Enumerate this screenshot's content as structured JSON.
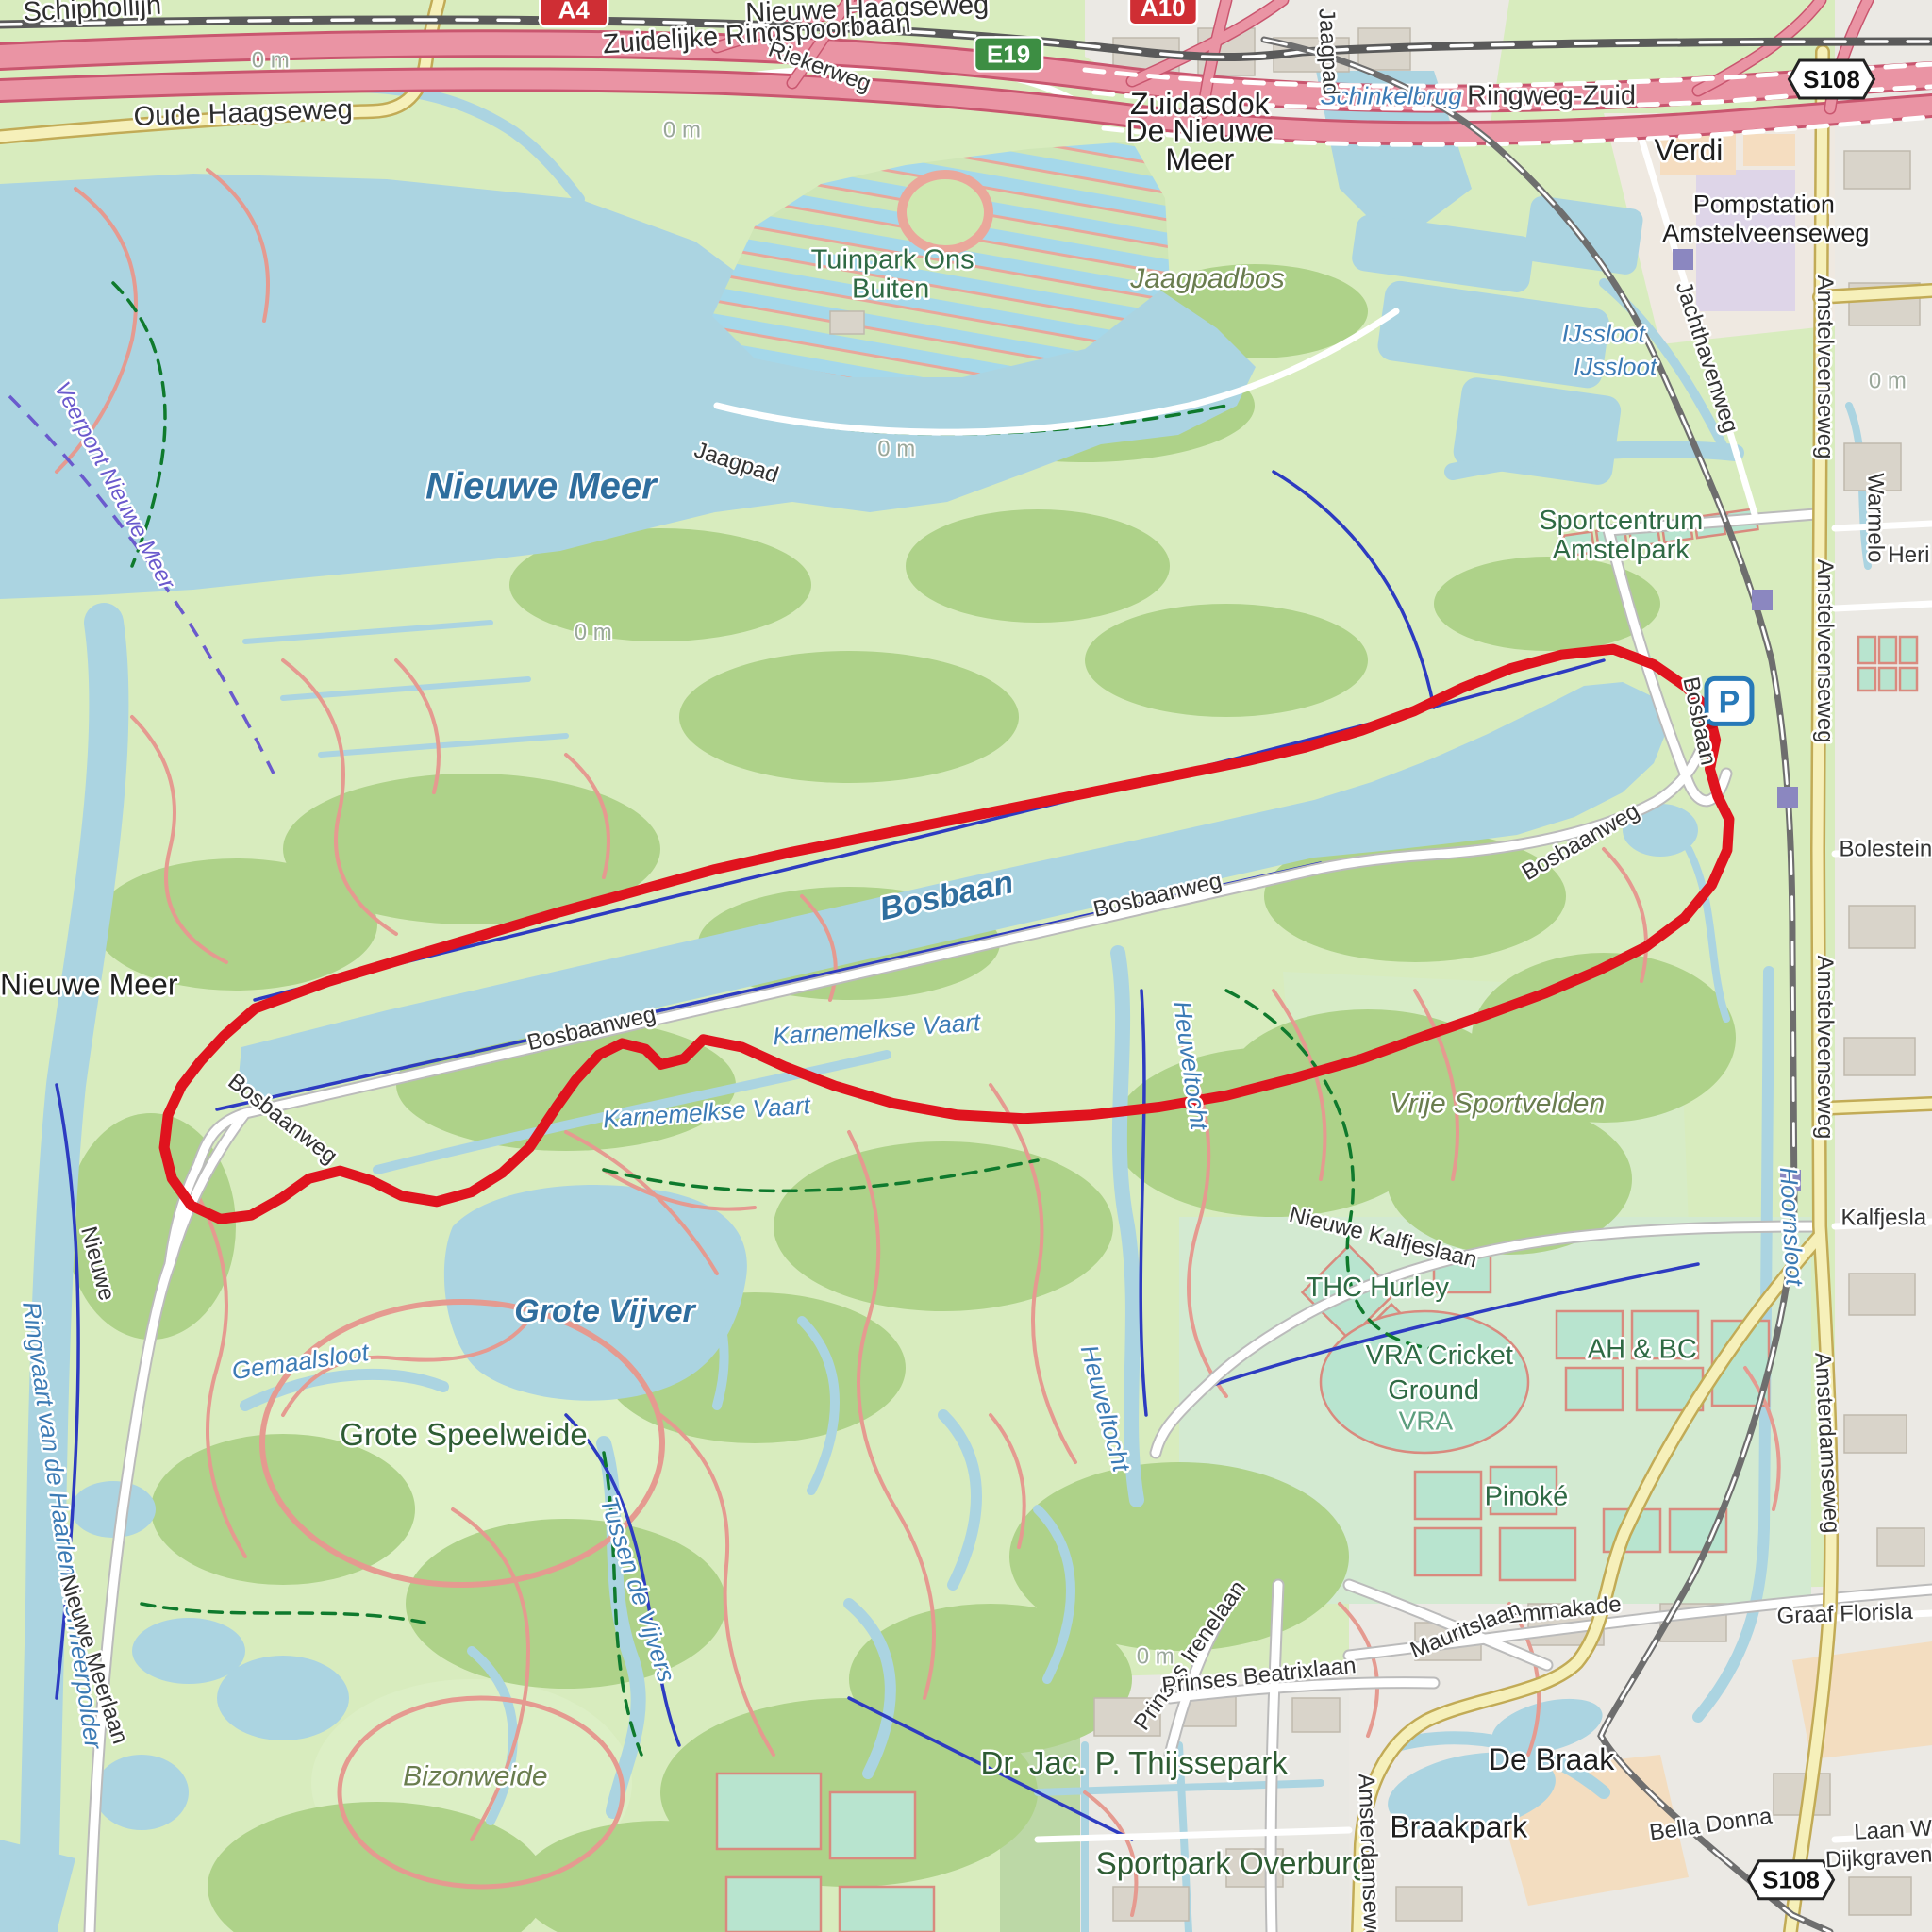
{
  "map": {
    "colors": {
      "route": "#e0131e",
      "route_dot": "#c01018",
      "water": "#abd4e1",
      "motorway": "#ea94a4",
      "road_yellow": "#f6f0ba",
      "parking_blue": "#2779b8",
      "shield_red": "#cf2e34",
      "shield_green": "#3d8e43"
    },
    "parking_icon": {
      "label": "P",
      "x": 89.5,
      "y": 36.3
    },
    "shields": [
      {
        "text": "A4",
        "type": "a",
        "x": 29.7,
        "y": 0.5
      },
      {
        "text": "A10",
        "type": "a",
        "x": 60.2,
        "y": 0.4
      },
      {
        "text": "E19",
        "type": "e",
        "x": 52.2,
        "y": 2.8
      },
      {
        "text": "S108",
        "type": "s",
        "x": 94.8,
        "y": 4.1
      },
      {
        "text": "S108",
        "type": "s",
        "x": 92.7,
        "y": 97.3
      }
    ],
    "labels": [
      {
        "t": "Schiphollijn",
        "x": 4.8,
        "y": 0.9,
        "r": -3,
        "c": "street-lg"
      },
      {
        "t": "Oude Haagseweg",
        "x": 12.6,
        "y": 6.3,
        "r": -2,
        "c": "street-lg"
      },
      {
        "t": "Nieuwe Haagseweg",
        "x": 44.9,
        "y": 0.9,
        "r": -2,
        "c": "street-lg"
      },
      {
        "t": "Zuidelijke Ringspoorbaan",
        "x": 39.2,
        "y": 2.2,
        "r": -4,
        "c": "street-lg"
      },
      {
        "t": "Riekerweg",
        "x": 42.3,
        "y": 3.8,
        "r": 20,
        "c": "street"
      },
      {
        "t": "Zuidasdok",
        "x": 62.1,
        "y": 5.9,
        "r": 0,
        "c": "place-m"
      },
      {
        "t": "De Nieuwe",
        "x": 62.1,
        "y": 7.3,
        "r": 0,
        "c": "place-m"
      },
      {
        "t": "Meer",
        "x": 62.1,
        "y": 8.8,
        "r": 0,
        "c": "place-m"
      },
      {
        "t": "Schinkelbrug",
        "x": 72.0,
        "y": 5.4,
        "r": 0,
        "c": "water-s"
      },
      {
        "t": "Ringweg-Zuid",
        "x": 80.3,
        "y": 5.4,
        "r": 0,
        "c": "street-lg"
      },
      {
        "t": "Jaagpad",
        "x": 68.4,
        "y": 2.7,
        "r": 87,
        "c": "street"
      },
      {
        "t": "Verdi",
        "x": 87.4,
        "y": 8.3,
        "r": 0,
        "c": "place-m"
      },
      {
        "t": "Pompstation",
        "x": 91.3,
        "y": 11.0,
        "r": 0,
        "c": "place-s"
      },
      {
        "t": "Amstelveenseweg",
        "x": 91.4,
        "y": 12.5,
        "r": 0,
        "c": "place-s"
      },
      {
        "t": "IJssloot",
        "x": 83.0,
        "y": 17.7,
        "r": 0,
        "c": "water-s"
      },
      {
        "t": "IJssloot",
        "x": 83.6,
        "y": 19.4,
        "r": 0,
        "c": "water-s"
      },
      {
        "t": "Jachthavenweg",
        "x": 88.0,
        "y": 18.6,
        "r": 72,
        "c": "street"
      },
      {
        "t": "Amstelveenseweg",
        "x": 94.1,
        "y": 19.0,
        "r": 90,
        "c": "street"
      },
      {
        "t": "Amstelveenseweg",
        "x": 94.1,
        "y": 33.7,
        "r": 90,
        "c": "street"
      },
      {
        "t": "Amstelveenseweg",
        "x": 94.1,
        "y": 54.2,
        "r": 90,
        "c": "street"
      },
      {
        "t": "Warmelo",
        "x": 96.7,
        "y": 26.8,
        "r": 90,
        "c": "street"
      },
      {
        "t": "Heri",
        "x": 98.8,
        "y": 29.1,
        "r": 0,
        "c": "street"
      },
      {
        "t": "Tuinpark Ons",
        "x": 46.2,
        "y": 13.9,
        "r": 0,
        "c": "park"
      },
      {
        "t": "Buiten",
        "x": 46.1,
        "y": 15.4,
        "r": 0,
        "c": "park"
      },
      {
        "t": "Jaagpadbos",
        "x": 62.5,
        "y": 14.9,
        "r": 0,
        "c": "area"
      },
      {
        "t": "Jaagpad",
        "x": 38.0,
        "y": 24.3,
        "r": 18,
        "c": "street"
      },
      {
        "t": "Veerpont Nieuwe Meer",
        "x": 5.6,
        "y": 25.3,
        "r": 62,
        "c": "ferry"
      },
      {
        "t": "Nieuwe Meer",
        "x": 28.0,
        "y": 25.8,
        "r": 0,
        "c": "water-xl"
      },
      {
        "t": "Nieuwe Meer",
        "x": 4.6,
        "y": 51.5,
        "r": 0,
        "c": "place-m"
      },
      {
        "t": "Sportcentrum",
        "x": 83.9,
        "y": 27.4,
        "r": 0,
        "c": "park"
      },
      {
        "t": "Amstelpark",
        "x": 83.9,
        "y": 28.9,
        "r": 0,
        "c": "park"
      },
      {
        "t": "Bosbaan",
        "x": 87.6,
        "y": 37.4,
        "r": 78,
        "c": "street"
      },
      {
        "t": "Bosbaan",
        "x": 49.1,
        "y": 46.9,
        "r": -12,
        "c": "water-l"
      },
      {
        "t": "Bosbaanweg",
        "x": 60.0,
        "y": 46.7,
        "r": -13,
        "c": "street"
      },
      {
        "t": "Bosbaanweg",
        "x": 30.7,
        "y": 53.6,
        "r": -13,
        "c": "street"
      },
      {
        "t": "Bosbaanweg",
        "x": 14.4,
        "y": 58.2,
        "r": 38,
        "c": "street"
      },
      {
        "t": "Bosbaanweg",
        "x": 82.0,
        "y": 43.9,
        "r": -30,
        "c": "street"
      },
      {
        "t": "Karnemelkse Vaart",
        "x": 36.6,
        "y": 58.0,
        "r": -4,
        "c": "water-s"
      },
      {
        "t": "Karnemelkse Vaart",
        "x": 45.4,
        "y": 53.7,
        "r": -4,
        "c": "water-s"
      },
      {
        "t": "Heuveltocht",
        "x": 61.2,
        "y": 55.2,
        "r": 82,
        "c": "water-s"
      },
      {
        "t": "Heuveltocht",
        "x": 56.8,
        "y": 73.0,
        "r": 75,
        "c": "water-s"
      },
      {
        "t": "Vrije Sportvelden",
        "x": 77.5,
        "y": 57.6,
        "r": 0,
        "c": "area"
      },
      {
        "t": "Hoornsloot",
        "x": 92.3,
        "y": 63.5,
        "r": 87,
        "c": "water-s"
      },
      {
        "t": "Bolestein",
        "x": 97.6,
        "y": 44.3,
        "r": 0,
        "c": "street"
      },
      {
        "t": "Kalfjesla",
        "x": 97.5,
        "y": 63.4,
        "r": 0,
        "c": "street"
      },
      {
        "t": "Nieuwe Kalfjeslaan",
        "x": 71.5,
        "y": 64.4,
        "r": 14,
        "c": "street"
      },
      {
        "t": "THC Hurley",
        "x": 71.3,
        "y": 67.1,
        "r": 0,
        "c": "park"
      },
      {
        "t": "VRA Cricket",
        "x": 74.5,
        "y": 70.6,
        "r": 0,
        "c": "park"
      },
      {
        "t": "Ground",
        "x": 74.2,
        "y": 72.4,
        "r": 0,
        "c": "park"
      },
      {
        "t": "VRA",
        "x": 73.8,
        "y": 74.0,
        "r": 0,
        "c": "area-teal"
      },
      {
        "t": "AH & BC",
        "x": 85.0,
        "y": 70.3,
        "r": 0,
        "c": "park"
      },
      {
        "t": "Pinoké",
        "x": 79.0,
        "y": 77.9,
        "r": 0,
        "c": "park"
      },
      {
        "t": "Grote Vijver",
        "x": 31.3,
        "y": 68.4,
        "r": 0,
        "c": "water-l"
      },
      {
        "t": "Gemaalsloot",
        "x": 15.6,
        "y": 70.9,
        "r": -8,
        "c": "water-s"
      },
      {
        "t": "Grote Speelweide",
        "x": 24.0,
        "y": 74.8,
        "r": 0,
        "c": "park-l"
      },
      {
        "t": "Tussen de Vijvers",
        "x": 32.6,
        "y": 82.4,
        "r": 72,
        "c": "water-s"
      },
      {
        "t": "Bizonweide",
        "x": 24.6,
        "y": 92.4,
        "r": 0,
        "c": "area"
      },
      {
        "t": "Ringvaart van de Haarlemmermeerpolder",
        "x": 2.8,
        "y": 79.0,
        "r": 82,
        "c": "water-s"
      },
      {
        "t": "Nieuwe",
        "x": 4.7,
        "y": 65.5,
        "r": 75,
        "c": "street"
      },
      {
        "t": "Nieuwe Meerlaan",
        "x": 4.5,
        "y": 86.0,
        "r": 72,
        "c": "street"
      },
      {
        "t": "Dr. Jac. P. Thijssepark",
        "x": 58.7,
        "y": 91.8,
        "r": 0,
        "c": "park-l"
      },
      {
        "t": "Prinses Irenelaan",
        "x": 61.9,
        "y": 85.9,
        "r": -55,
        "c": "street"
      },
      {
        "t": "Prinses Beatrixlaan",
        "x": 65.2,
        "y": 87.1,
        "r": -6,
        "c": "street"
      },
      {
        "t": "Emmakade",
        "x": 81.0,
        "y": 83.7,
        "r": -6,
        "c": "street"
      },
      {
        "t": "Mauritslaan",
        "x": 76.0,
        "y": 84.7,
        "r": -22,
        "c": "street"
      },
      {
        "t": "De Braak",
        "x": 80.3,
        "y": 91.6,
        "r": 0,
        "c": "place-m"
      },
      {
        "t": "Braakpark",
        "x": 75.5,
        "y": 95.1,
        "r": 0,
        "c": "place-m"
      },
      {
        "t": "Sportpark Overburg",
        "x": 63.8,
        "y": 97.0,
        "r": 0,
        "c": "park-l"
      },
      {
        "t": "Amsterdamseweg",
        "x": 94.2,
        "y": 74.7,
        "r": 87,
        "c": "street"
      },
      {
        "t": "Amsterdamseweg",
        "x": 70.5,
        "y": 96.5,
        "r": 88,
        "c": "street"
      },
      {
        "t": "Bella Donna",
        "x": 88.6,
        "y": 94.8,
        "r": -8,
        "c": "street"
      },
      {
        "t": "Laan W",
        "x": 98.0,
        "y": 95.1,
        "r": -3,
        "c": "street"
      },
      {
        "t": "Dijkgravenl",
        "x": 97.4,
        "y": 96.5,
        "r": -3,
        "c": "street"
      },
      {
        "t": "Graaf Florisla",
        "x": 95.5,
        "y": 83.9,
        "r": -2,
        "c": "street"
      },
      {
        "t": "0 m",
        "x": 14.0,
        "y": 3.5,
        "r": 0,
        "c": "contour"
      },
      {
        "t": "0 m",
        "x": 35.3,
        "y": 7.1,
        "r": 0,
        "c": "contour"
      },
      {
        "t": "0 m",
        "x": 46.4,
        "y": 23.6,
        "r": 0,
        "c": "contour"
      },
      {
        "t": "0 m",
        "x": 97.7,
        "y": 20.1,
        "r": 0,
        "c": "contour"
      },
      {
        "t": "0 m",
        "x": 59.8,
        "y": 86.1,
        "r": 0,
        "c": "contour"
      },
      {
        "t": "0 m",
        "x": 30.7,
        "y": 33.1,
        "r": 0,
        "c": "contour"
      }
    ],
    "route": {
      "width": 11,
      "end_dot": [
        88.5,
        37.1
      ],
      "points": [
        [
          13.2,
          52.2
        ],
        [
          17,
          50.8
        ],
        [
          21,
          49.6
        ],
        [
          25,
          48.4
        ],
        [
          29,
          47.2
        ],
        [
          33,
          46.1
        ],
        [
          37,
          45
        ],
        [
          41,
          44.1
        ],
        [
          45,
          43.3
        ],
        [
          49,
          42.5
        ],
        [
          53,
          41.7
        ],
        [
          57,
          40.9
        ],
        [
          61,
          40.1
        ],
        [
          64.5,
          39.4
        ],
        [
          67.5,
          38.7
        ],
        [
          70.5,
          37.8
        ],
        [
          73.2,
          36.8
        ],
        [
          75.7,
          35.6
        ],
        [
          78.2,
          34.6
        ],
        [
          80.8,
          33.9
        ],
        [
          83.5,
          33.6
        ],
        [
          85.6,
          34.4
        ],
        [
          87.2,
          35.5
        ],
        [
          88.3,
          36.6
        ],
        [
          88.5,
          37.1
        ],
        [
          88.8,
          38.3
        ],
        [
          88.5,
          39.8
        ],
        [
          88.9,
          41.2
        ],
        [
          89.5,
          42.4
        ],
        [
          89.4,
          44
        ],
        [
          88.6,
          45.8
        ],
        [
          87.2,
          47.5
        ],
        [
          85.2,
          49
        ],
        [
          82.8,
          50.2
        ],
        [
          80,
          51.4
        ],
        [
          77,
          52.5
        ],
        [
          73.8,
          53.6
        ],
        [
          70.5,
          54.8
        ],
        [
          67,
          55.8
        ],
        [
          63.5,
          56.7
        ],
        [
          60,
          57.3
        ],
        [
          56.5,
          57.7
        ],
        [
          53,
          57.9
        ],
        [
          49.5,
          57.7
        ],
        [
          46.2,
          57.1
        ],
        [
          43.2,
          56.2
        ],
        [
          40.6,
          55.2
        ],
        [
          38.4,
          54.2
        ],
        [
          36.4,
          53.8
        ],
        [
          35.4,
          54.8
        ],
        [
          34.2,
          55.1
        ],
        [
          33.4,
          54.3
        ],
        [
          32.2,
          54
        ],
        [
          31,
          54.6
        ],
        [
          29.8,
          55.9
        ],
        [
          28.8,
          57.3
        ],
        [
          27.4,
          59.4
        ],
        [
          26,
          60.7
        ],
        [
          24.4,
          61.7
        ],
        [
          22.6,
          62.2
        ],
        [
          20.8,
          61.9
        ],
        [
          19.2,
          61.1
        ],
        [
          17.6,
          60.6
        ],
        [
          16,
          61
        ],
        [
          14.6,
          62
        ],
        [
          13,
          62.9
        ],
        [
          11.4,
          63.1
        ],
        [
          9.9,
          62.4
        ],
        [
          8.9,
          61
        ],
        [
          8.5,
          59.4
        ],
        [
          8.7,
          57.7
        ],
        [
          9.4,
          56.2
        ],
        [
          10.4,
          54.9
        ],
        [
          11.6,
          53.6
        ],
        [
          13.2,
          52.2
        ]
      ]
    }
  }
}
